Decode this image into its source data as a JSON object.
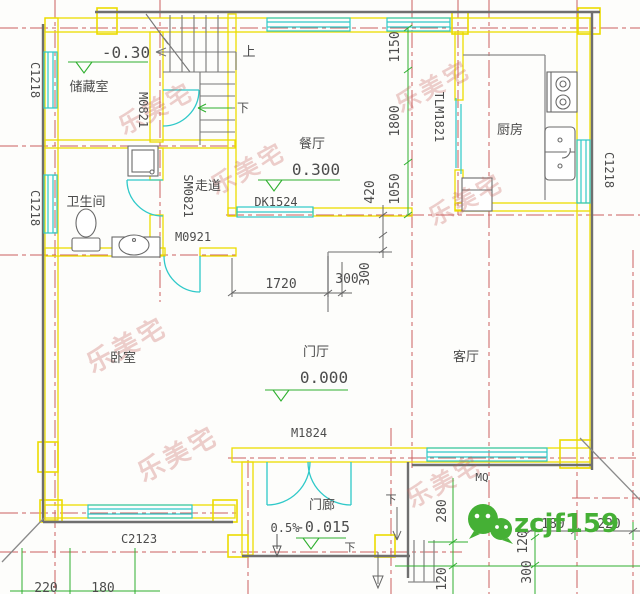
{
  "watermark": {
    "stamp": "乐美宅",
    "wechat_id": "zcjf159"
  },
  "rooms": {
    "storage": "储藏室",
    "bathroom": "卫生间",
    "bedroom": "卧室",
    "corridor": "走道",
    "dining": "餐厅",
    "kitchen": "厨房",
    "living": "客厅",
    "hall": "门厅",
    "porch": "门廊"
  },
  "codes": {
    "window_left_top": "C1218",
    "window_left_mid": "C1218",
    "window_right": "C1218",
    "door_storage": "M0821",
    "door_bathroom": "SM0821",
    "door_bedroom": "M0921",
    "opening_dining": "DK1524",
    "door_kitchen": "TLM1821",
    "window_bedroom": "C2123",
    "door_entry": "M1824",
    "window_living": "MQ"
  },
  "levels": {
    "storage": "-0.30",
    "dining": "0.300",
    "hall": "0.000",
    "porch": "-0.015",
    "slope": "0.5%"
  },
  "stairs": {
    "up": "上",
    "down_mid": "下",
    "down_porch": "下",
    "down_steps": "下"
  },
  "dims": {
    "d1150": "1150",
    "d1800": "1800",
    "d1050": "1050",
    "d420": "420",
    "d1720": "1720",
    "d300_h": "300",
    "d300_v": "300",
    "d280": "280",
    "d120_a": "120",
    "d120_b": "120",
    "d300_c": "300",
    "d180_r": "180",
    "d220_r": "220",
    "d220_l": "220",
    "d180_l": "180"
  }
}
